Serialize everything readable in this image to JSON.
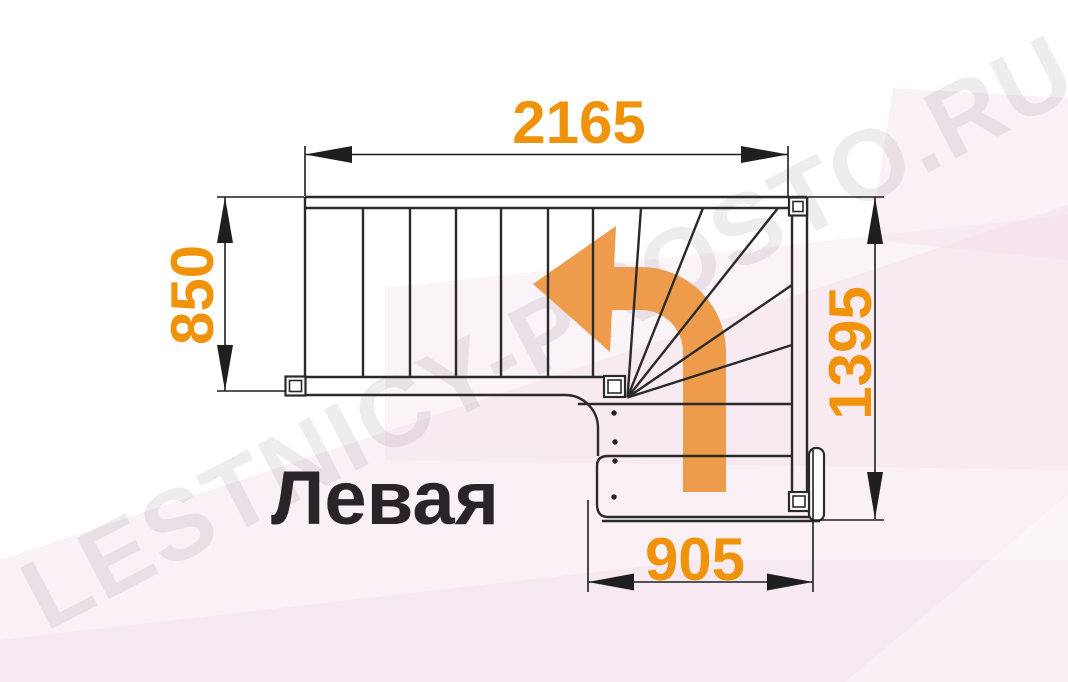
{
  "drawing": {
    "type": "staircase-floor-plan",
    "view": "top-down",
    "orientation_label": "Левая",
    "turn_direction": "up-then-left",
    "straight_treads": 6,
    "winder_treads": 5,
    "lower_flight_treads": 3
  },
  "dimensions_mm": {
    "top_width": "2165",
    "left_depth": "850",
    "right_depth": "1395",
    "bottom_width": "905"
  },
  "watermark": {
    "text": "LESTNICY-PROSTO.RU"
  },
  "colors": {
    "dimension_text": "#f0930b",
    "arrow_fill": "#ee9c4c",
    "line_dark": "#2a2a2a",
    "dimension_line": "#1f1f1f",
    "background_tint": "#f3dfeb",
    "watermark_tint": "#40304a",
    "label_text": "#28242a"
  }
}
